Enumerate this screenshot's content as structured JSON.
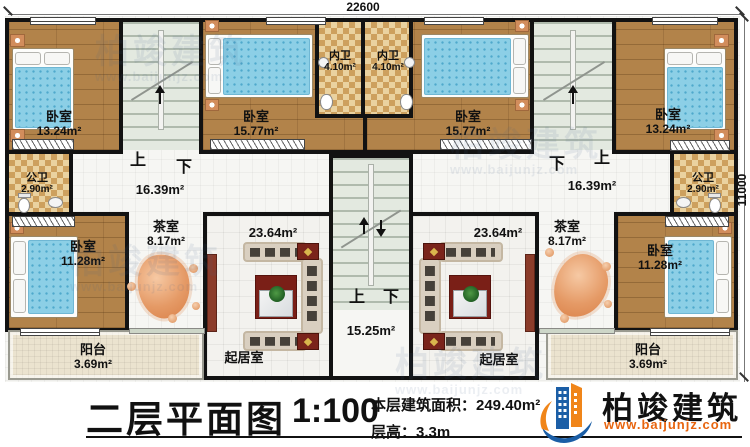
{
  "dimensions": {
    "width": "22600",
    "height": "11000"
  },
  "stair": {
    "up": "上",
    "down": "下"
  },
  "rooms": {
    "bedroom_tl": {
      "label": "卧室",
      "area": "13.24m²"
    },
    "bedroom_tml": {
      "label": "卧室",
      "area": "15.77m²"
    },
    "bath_inner_left": {
      "label": "内卫",
      "area": "4.10m²"
    },
    "bath_inner_right": {
      "label": "内卫",
      "area": "4.10m²"
    },
    "bedroom_tmr": {
      "label": "卧室",
      "area": "15.77m²"
    },
    "bedroom_tr": {
      "label": "卧室",
      "area": "13.24m²"
    },
    "bath_public_left": {
      "label": "公卫",
      "area": "2.90m²"
    },
    "bath_public_right": {
      "label": "公卫",
      "area": "2.90m²"
    },
    "hall_left": {
      "area": "16.39m²"
    },
    "hall_right": {
      "area": "16.39m²"
    },
    "tea_left": {
      "label": "茶室",
      "area": "8.17m²"
    },
    "tea_right": {
      "label": "茶室",
      "area": "8.17m²"
    },
    "bedroom_bl": {
      "label": "卧室",
      "area": "11.28m²"
    },
    "bedroom_br": {
      "label": "卧室",
      "area": "11.28m²"
    },
    "living_left": {
      "label": "起居室",
      "area": "23.64m²"
    },
    "living_right": {
      "label": "起居室",
      "area": "23.64m²"
    },
    "stair_hall": {
      "area": "15.25m²"
    },
    "balcony_left": {
      "label": "阳台",
      "area": "3.69m²"
    },
    "balcony_right": {
      "label": "阳台",
      "area": "3.69m²"
    }
  },
  "titleblock": {
    "title": "二层平面图",
    "scale": "1:100",
    "building_area": "本层建筑面积：249.40m²",
    "floor_height": "层高：3.3m"
  },
  "logo": {
    "name": "柏竣建筑",
    "url": "www.baijunjz.com"
  },
  "watermark": {
    "text": "柏竣建筑",
    "url": "www.baijunjz.com"
  },
  "colors": {
    "wall": "#121212",
    "wood_floor": "#b2834a",
    "bath_tile": "#ead2a0",
    "stair_floor": "#e3e9e0",
    "mattress_blue": "#8ccfe6",
    "rug_red": "#7a1f17",
    "logo_blue": "#1b5ea6",
    "logo_orange": "#f08519",
    "url_orange": "#e8650f"
  }
}
